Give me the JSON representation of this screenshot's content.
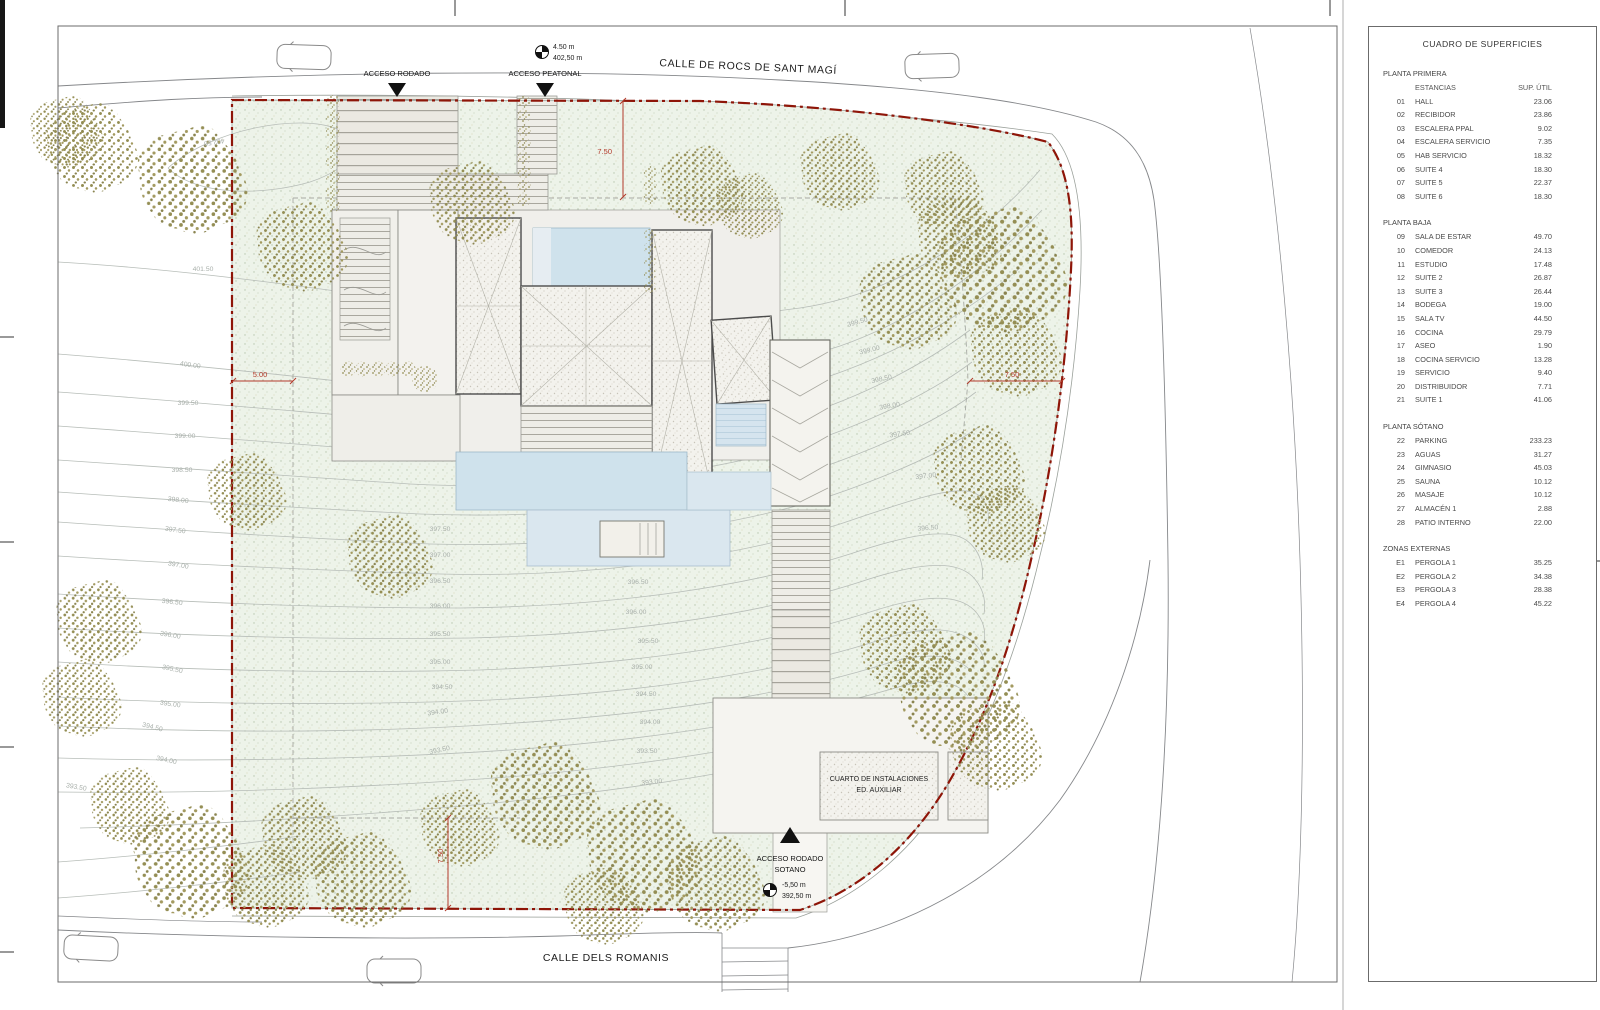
{
  "colors": {
    "boundary": "#8e1508",
    "dimension": "#b23a2a",
    "plot_fill": "#edf3e9",
    "pool": "#cfe2ec",
    "tree_olive": "#948e54",
    "contour": "#b7bdb8"
  },
  "plan": {
    "labels": [
      {
        "t": "CALLE DE ROCS DE SANT MAGÍ",
        "x": 748,
        "y": 70,
        "c": "street",
        "r": 2.5,
        "n": "street-name-top"
      },
      {
        "t": "CALLE DELS ROMANIS",
        "x": 606,
        "y": 961,
        "c": "street",
        "n": "street-name-bottom"
      },
      {
        "t": "ACCESO RODADO",
        "x": 397,
        "y": 76,
        "c": "label",
        "n": "acceso-rodado-label"
      },
      {
        "t": "ACCESO PEATONAL",
        "x": 545,
        "y": 76,
        "c": "label",
        "n": "acceso-peatonal-label"
      },
      {
        "t": "ACCESO RODADO",
        "x": 790,
        "y": 861,
        "c": "label",
        "n": "acceso-rodado-sotano-label"
      },
      {
        "t": "SOTANO",
        "x": 790,
        "y": 872,
        "c": "label",
        "n": "acceso-sotano-label2"
      },
      {
        "t": "CUARTO DE INSTALACIONES",
        "x": 879,
        "y": 781,
        "c": "small",
        "n": "aux-room-label"
      },
      {
        "t": "ED. AUXILIAR",
        "x": 879,
        "y": 792,
        "c": "small",
        "n": "aux-room-label2"
      },
      {
        "t": "4.50 m",
        "x": 553,
        "y": 49,
        "c": "small",
        "a": "start",
        "n": "level-top-height"
      },
      {
        "t": "402,50 m",
        "x": 553,
        "y": 60,
        "c": "small",
        "a": "start",
        "n": "level-top-elevation"
      },
      {
        "t": "-5,50 m",
        "x": 782,
        "y": 887,
        "c": "small",
        "a": "start",
        "n": "level-bottom-height"
      },
      {
        "t": "392,50 m",
        "x": 782,
        "y": 898,
        "c": "small",
        "a": "start",
        "n": "level-bottom-elevation"
      },
      {
        "t": "5.00",
        "x": 260,
        "y": 377,
        "c": "dim",
        "n": "dim-5m"
      },
      {
        "t": "7.50",
        "x": 612,
        "y": 154,
        "c": "dim",
        "a": "end",
        "n": "dim-750-top"
      },
      {
        "t": "7.50",
        "x": 1012,
        "y": 377,
        "c": "dim",
        "n": "dim-750-right"
      },
      {
        "t": "7.50",
        "x": 443,
        "y": 856,
        "c": "dim",
        "r": -90,
        "n": "dim-750-bottom"
      },
      {
        "t": "402.50",
        "x": 214,
        "y": 140,
        "c": "c",
        "r": 172
      },
      {
        "t": "401.50",
        "x": 203,
        "y": 271,
        "c": "c"
      },
      {
        "t": "400.00",
        "x": 190,
        "y": 367,
        "c": "c",
        "r": 8
      },
      {
        "t": "399.50",
        "x": 188,
        "y": 405,
        "c": "c"
      },
      {
        "t": "399.00",
        "x": 185,
        "y": 438,
        "c": "c"
      },
      {
        "t": "398.50",
        "x": 182,
        "y": 472,
        "c": "c"
      },
      {
        "t": "398.00",
        "x": 178,
        "y": 502,
        "c": "c",
        "r": 6
      },
      {
        "t": "397.50",
        "x": 175,
        "y": 532,
        "c": "c",
        "r": 8
      },
      {
        "t": "397.00",
        "x": 178,
        "y": 567,
        "c": "c",
        "r": 10
      },
      {
        "t": "396.50",
        "x": 172,
        "y": 604,
        "c": "c",
        "r": 6
      },
      {
        "t": "396.00",
        "x": 170,
        "y": 637,
        "c": "c",
        "r": 10
      },
      {
        "t": "395.50",
        "x": 172,
        "y": 671,
        "c": "c",
        "r": 12
      },
      {
        "t": "395.00",
        "x": 170,
        "y": 706,
        "c": "c",
        "r": 8
      },
      {
        "t": "394.50",
        "x": 152,
        "y": 729,
        "c": "c",
        "r": 14
      },
      {
        "t": "394.00",
        "x": 166,
        "y": 762,
        "c": "c",
        "r": 12
      },
      {
        "t": "393.50",
        "x": 76,
        "y": 789,
        "c": "c",
        "r": 10
      },
      {
        "t": "397.50",
        "x": 440,
        "y": 531,
        "c": "c"
      },
      {
        "t": "397.00",
        "x": 440,
        "y": 557,
        "c": "c"
      },
      {
        "t": "396.50",
        "x": 440,
        "y": 583,
        "c": "c"
      },
      {
        "t": "396.00",
        "x": 440,
        "y": 608,
        "c": "c"
      },
      {
        "t": "395.50",
        "x": 440,
        "y": 636,
        "c": "c"
      },
      {
        "t": "395.00",
        "x": 440,
        "y": 664,
        "c": "c"
      },
      {
        "t": "394.50",
        "x": 442,
        "y": 689,
        "c": "c"
      },
      {
        "t": "394.00",
        "x": 438,
        "y": 714,
        "c": "c",
        "r": -8
      },
      {
        "t": "393.50",
        "x": 440,
        "y": 752,
        "c": "c",
        "r": -12
      },
      {
        "t": "396.50",
        "x": 638,
        "y": 584,
        "c": "c"
      },
      {
        "t": "396.00",
        "x": 636,
        "y": 614,
        "c": "c"
      },
      {
        "t": "395.50",
        "x": 648,
        "y": 643,
        "c": "c"
      },
      {
        "t": "395.00",
        "x": 642,
        "y": 669,
        "c": "c"
      },
      {
        "t": "394.50",
        "x": 646,
        "y": 696,
        "c": "c"
      },
      {
        "t": "394.00",
        "x": 650,
        "y": 724,
        "c": "c"
      },
      {
        "t": "393.50",
        "x": 647,
        "y": 753,
        "c": "c"
      },
      {
        "t": "393.00",
        "x": 652,
        "y": 784,
        "c": "c",
        "r": -6
      },
      {
        "t": "399.50",
        "x": 858,
        "y": 324,
        "c": "c",
        "r": -16
      },
      {
        "t": "399.00",
        "x": 870,
        "y": 352,
        "c": "c",
        "r": -14
      },
      {
        "t": "398.50",
        "x": 882,
        "y": 381,
        "c": "c",
        "r": -12
      },
      {
        "t": "398.00",
        "x": 890,
        "y": 408,
        "c": "c",
        "r": -10
      },
      {
        "t": "397.50",
        "x": 900,
        "y": 436,
        "c": "c",
        "r": -8
      },
      {
        "t": "397.00",
        "x": 926,
        "y": 478,
        "c": "c",
        "r": -6
      },
      {
        "t": "396.50",
        "x": 928,
        "y": 530,
        "c": "c",
        "r": -4
      }
    ]
  },
  "table": {
    "title": "CUADRO DE SUPERFICIES",
    "col_estancias": "ESTANCIAS",
    "col_sup": "SUP. ÚTIL",
    "sections": [
      {
        "title": "PLANTA PRIMERA",
        "header": true,
        "rows": [
          [
            "01",
            "HALL",
            "23.06"
          ],
          [
            "02",
            "RECIBIDOR",
            "23.86"
          ],
          [
            "03",
            "ESCALERA PPAL",
            "9.02"
          ],
          [
            "04",
            "ESCALERA SERVICIO",
            "7.35"
          ],
          [
            "05",
            "HAB SERVICIO",
            "18.32"
          ],
          [
            "06",
            "SUITE 4",
            "18.30"
          ],
          [
            "07",
            "SUITE 5",
            "22.37"
          ],
          [
            "08",
            "SUITE 6",
            "18.30"
          ]
        ]
      },
      {
        "title": "PLANTA BAJA",
        "rows": [
          [
            "09",
            "SALA DE ESTAR",
            "49.70"
          ],
          [
            "10",
            "COMEDOR",
            "24.13"
          ],
          [
            "11",
            "ESTUDIO",
            "17.48"
          ],
          [
            "12",
            "SUITE 2",
            "26.87"
          ],
          [
            "13",
            "SUITE 3",
            "26.44"
          ],
          [
            "14",
            "BODEGA",
            "19.00"
          ],
          [
            "15",
            "SALA TV",
            "44.50"
          ],
          [
            "16",
            "COCINA",
            "29.79"
          ],
          [
            "17",
            "ASEO",
            "1.90"
          ],
          [
            "18",
            "COCINA SERVICIO",
            "13.28"
          ],
          [
            "19",
            "SERVICIO",
            "9.40"
          ],
          [
            "20",
            "DISTRIBUIDOR",
            "7.71"
          ],
          [
            "21",
            "SUITE 1",
            "41.06"
          ]
        ]
      },
      {
        "title": "PLANTA SÓTANO",
        "rows": [
          [
            "22",
            "PARKING",
            "233.23"
          ],
          [
            "23",
            "AGUAS",
            "31.27"
          ],
          [
            "24",
            "GIMNASIO",
            "45.03"
          ],
          [
            "25",
            "SAUNA",
            "10.12"
          ],
          [
            "26",
            "MASAJE",
            "10.12"
          ],
          [
            "27",
            "ALMACÉN 1",
            "2.88"
          ],
          [
            "28",
            "PATIO INTERNO",
            "22.00"
          ]
        ]
      },
      {
        "title": "ZONAS EXTERNAS",
        "rows": [
          [
            "E1",
            "PERGOLA 1",
            "35.25"
          ],
          [
            "E2",
            "PERGOLA 2",
            "34.38"
          ],
          [
            "E3",
            "PERGOLA 3",
            "28.38"
          ],
          [
            "E4",
            "PERGOLA 4",
            "45.22"
          ]
        ]
      }
    ]
  }
}
